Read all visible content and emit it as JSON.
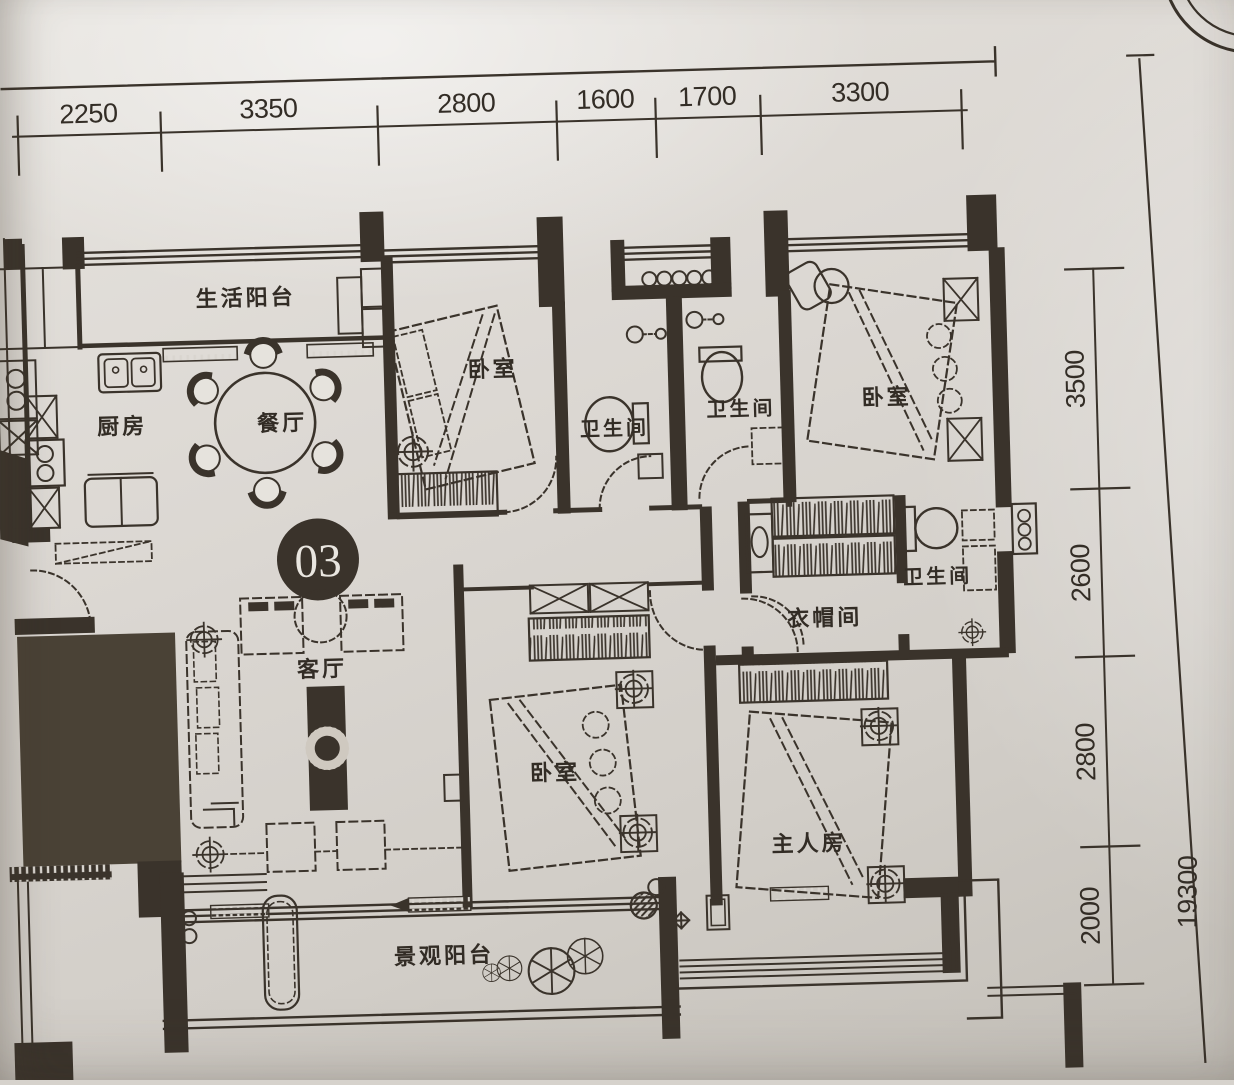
{
  "plan": {
    "unit_badge": "03",
    "labels": {
      "service_balcony": "生活阳台",
      "kitchen": "厨房",
      "dining": "餐厅",
      "bedroom_top_left": "卧室",
      "bath_1": "卫生间",
      "bath_2": "卫生间",
      "bedroom_top_right": "卧室",
      "closet": "衣帽间",
      "bath_master": "卫生间",
      "living": "客厅",
      "bedroom_bottom": "卧室",
      "master_bedroom": "主人房",
      "view_balcony": "景观阳台"
    },
    "dimensions": {
      "top": [
        "2250",
        "3350",
        "2800",
        "1600",
        "1700",
        "3300"
      ],
      "right": [
        "3500",
        "2600",
        "2800",
        "2000"
      ],
      "right_total": "19300"
    }
  }
}
